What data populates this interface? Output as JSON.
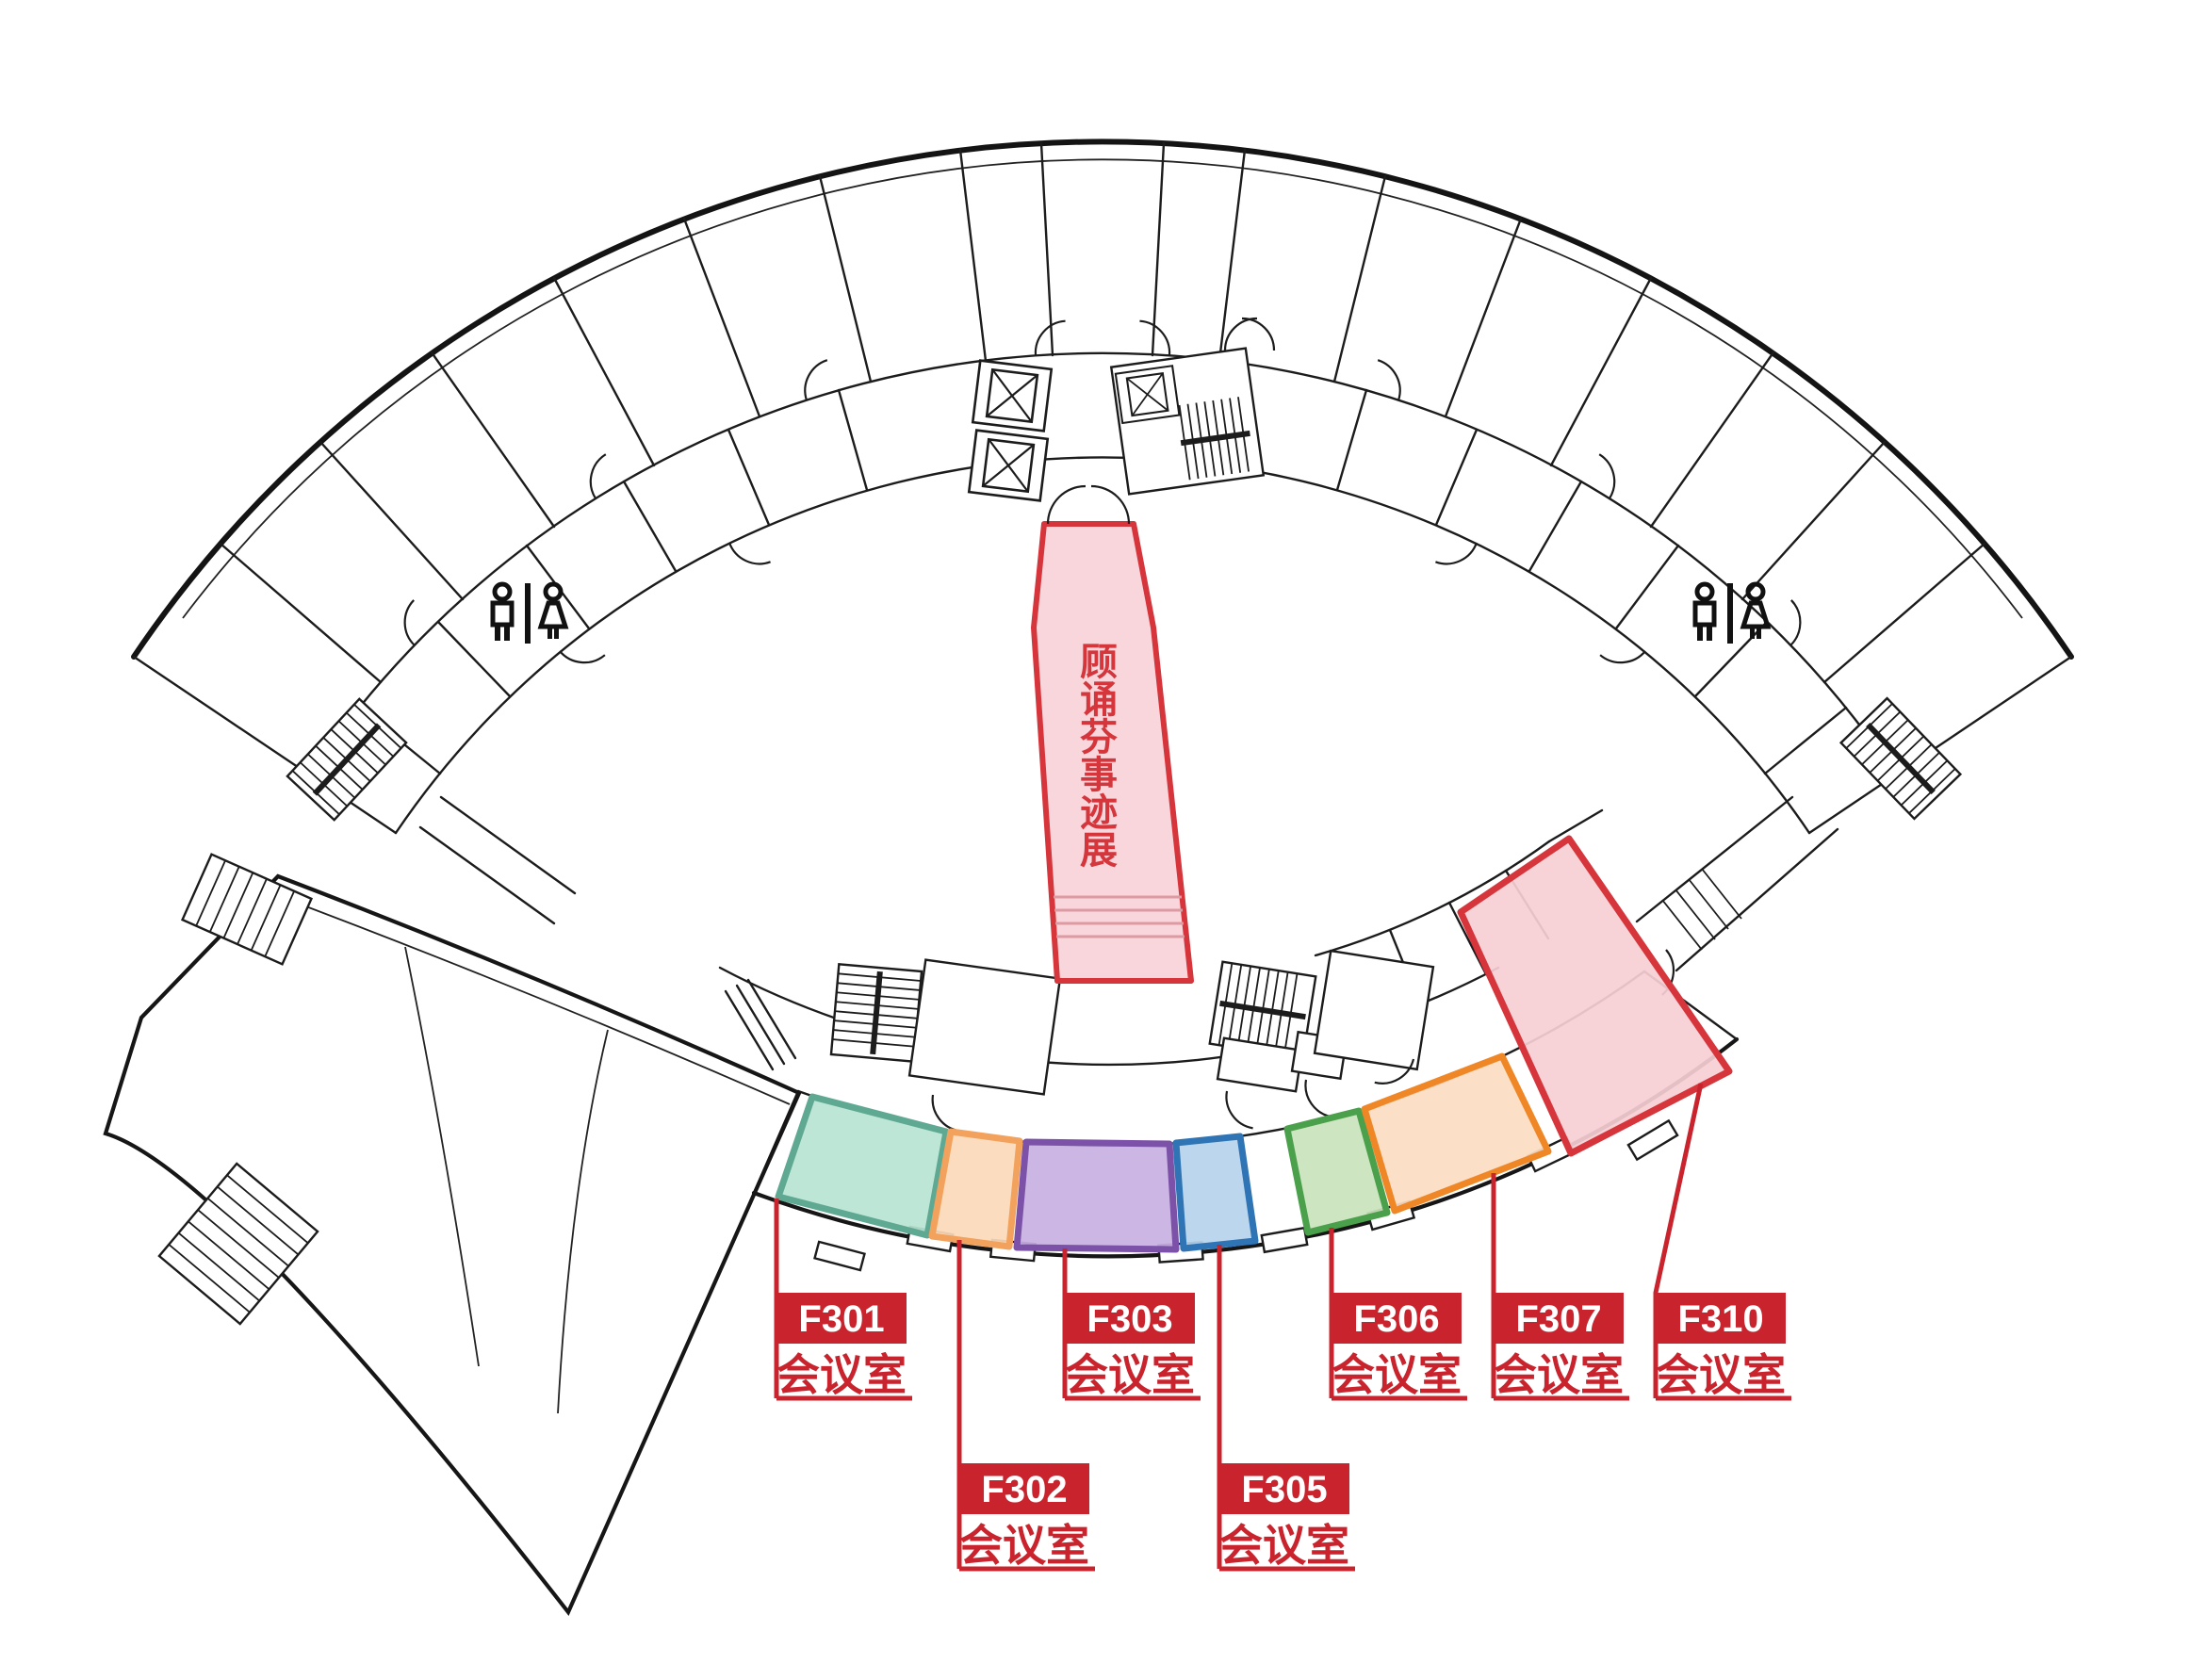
{
  "exhibition": {
    "name": "顾诵芬事迹展",
    "chars": [
      "顾",
      "诵",
      "芬",
      "事",
      "迹",
      "展"
    ],
    "fill": "#f8d2d7",
    "stroke": "#d5353b",
    "text_color": "#d4363c"
  },
  "rooms": [
    {
      "id": "F301",
      "type": "会议室",
      "fill": "#b9e4d2",
      "stroke": "#5fa993"
    },
    {
      "id": "F302",
      "type": "会议室",
      "fill": "#fcd9b8",
      "stroke": "#f2a25c"
    },
    {
      "id": "F303",
      "type": "会议室",
      "fill": "#c7b0e2",
      "stroke": "#7c52a8"
    },
    {
      "id": "F305",
      "type": "会议室",
      "fill": "#b5d3eb",
      "stroke": "#2f74b5"
    },
    {
      "id": "F306",
      "type": "会议室",
      "fill": "#c9e3bc",
      "stroke": "#4ba04b"
    },
    {
      "id": "F307",
      "type": "会议室",
      "fill": "#fcdcc2",
      "stroke": "#ef8727"
    },
    {
      "id": "F310",
      "type": "会议室",
      "fill": "#f6ced4",
      "stroke": "#d5353b"
    }
  ],
  "legend": {
    "label_bg": "#c9242d",
    "label_text": "#ffffff",
    "leader": "#c9242d"
  },
  "icons": {
    "restroom": "male-female-wc"
  }
}
